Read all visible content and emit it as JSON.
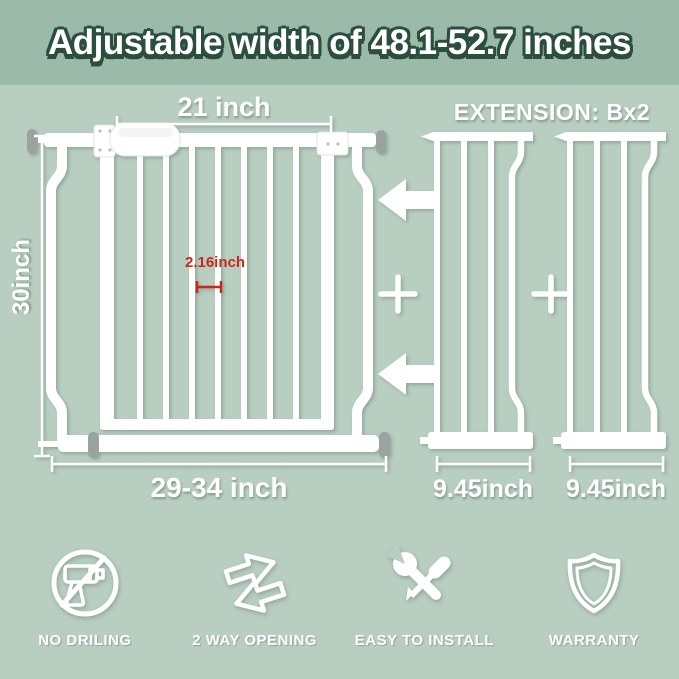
{
  "title": "Adjustable width of 48.1-52.7 inches",
  "diagram": {
    "gate": {
      "door_width": "21 inch",
      "height": "30inch",
      "bar_gap": "2.16inch",
      "adjustable_width": "29-34 inch"
    },
    "extension": {
      "heading": "EXTENSION: Bx2",
      "plus_sign": "+",
      "panels": [
        {
          "width": "9.45inch"
        },
        {
          "width": "9.45inch"
        }
      ]
    }
  },
  "features": [
    {
      "icon": "no-drilling-icon",
      "label": "NO DRILING"
    },
    {
      "icon": "two-way-opening-icon",
      "label": "2 WAY OPENING"
    },
    {
      "icon": "easy-install-icon",
      "label": "EASY TO INSTALL"
    },
    {
      "icon": "warranty-shield-icon",
      "label": "WARRANTY"
    }
  ],
  "colors": {
    "header_bg": "#9cbaa9",
    "body_bg": "#b7cec0",
    "title_text": "#ffffff",
    "title_outline": "#2b4e3e",
    "line_art": "#ffffff",
    "measurement_accent": "#c9291a",
    "screw_gray": "#99a4a0"
  }
}
